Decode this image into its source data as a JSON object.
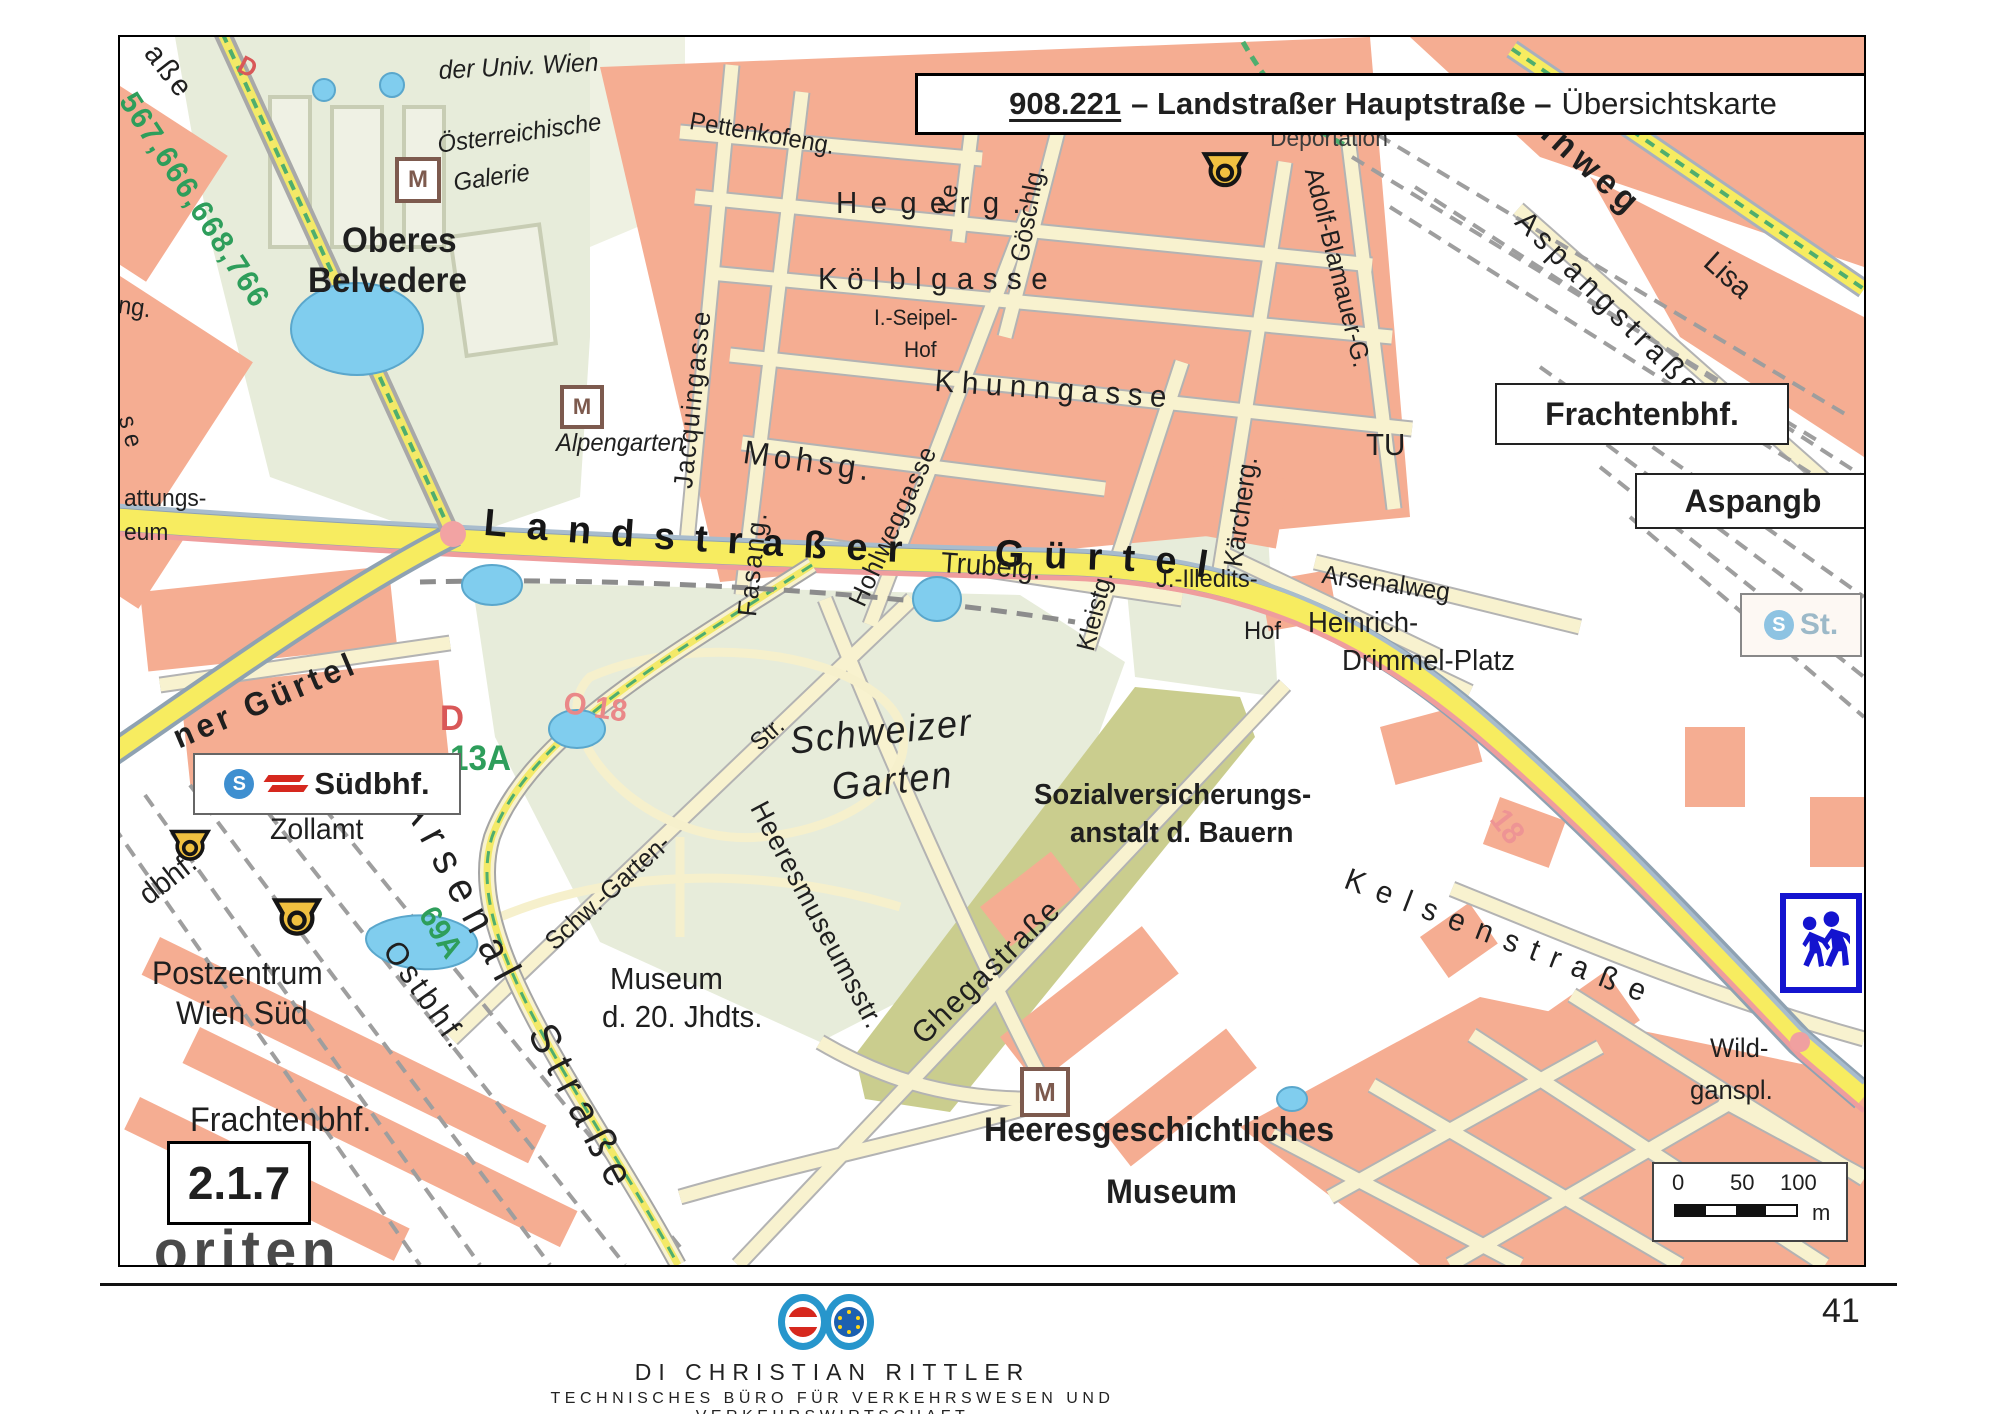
{
  "title": {
    "number": "908.221",
    "middle": "– Landstraßer Hauptstraße –",
    "suffix": "Übersichtskarte"
  },
  "map": {
    "section_label": "2.1.7",
    "guertel_label": "Landstraßer Gürtel",
    "boxes": {
      "frachtenbhf": "Frachtenbhf.",
      "aspangb": "Aspangb",
      "suedbhf": "Südbhf.",
      "st": "St."
    },
    "icons": {
      "museum_glyph": "M",
      "sbahn_glyph": "S"
    },
    "scale": {
      "t0": "0",
      "t50": "50",
      "t100": "100",
      "unit": "m"
    },
    "labels": [
      {
        "t": "aße",
        "x": 42,
        "y": 2,
        "s": 30,
        "r": 52,
        "ls": 4
      },
      {
        "t": "D",
        "x": 126,
        "y": 14,
        "s": 26,
        "r": 28,
        "c": "#d95858",
        "w": 700,
        "n": "label-tram-d-fragment"
      },
      {
        "t": "567,666,668,766",
        "x": 20,
        "y": 50,
        "s": 31,
        "r": 57,
        "c": "#2e9e5b",
        "w": 700,
        "ls": 2,
        "n": "label-bus-lines"
      },
      {
        "t": "der Univ. Wien",
        "x": 318,
        "y": 20,
        "s": 26,
        "i": 1,
        "r": -3
      },
      {
        "t": "Österreichische",
        "x": 316,
        "y": 96,
        "s": 25,
        "i": 1,
        "r": -8
      },
      {
        "t": "Galerie",
        "x": 332,
        "y": 134,
        "s": 25,
        "i": 1,
        "r": -8
      },
      {
        "t": "Oberes",
        "x": 222,
        "y": 186,
        "s": 35,
        "w": 600
      },
      {
        "t": "Belvedere",
        "x": 188,
        "y": 226,
        "s": 35,
        "w": 600
      },
      {
        "t": "Alpengarten",
        "x": 436,
        "y": 394,
        "s": 25,
        "i": 1
      },
      {
        "t": "Pettenkofeng.",
        "x": 572,
        "y": 72,
        "s": 25,
        "r": 10
      },
      {
        "t": "Ke",
        "x": 815,
        "y": 175,
        "s": 25,
        "r": -84
      },
      {
        "t": "Hegerg.",
        "x": 716,
        "y": 150,
        "s": 31,
        "ls": 14
      },
      {
        "t": "Kölblgasse",
        "x": 698,
        "y": 226,
        "s": 31,
        "ls": 10
      },
      {
        "t": "I.-Seipel-",
        "x": 754,
        "y": 270,
        "s": 22
      },
      {
        "t": "Hof",
        "x": 784,
        "y": 302,
        "s": 22,
        "n": "label-seipel-hof"
      },
      {
        "t": "Khunngasse",
        "x": 816,
        "y": 328,
        "s": 31,
        "ls": 8,
        "r": 4
      },
      {
        "t": "Mohsg.",
        "x": 626,
        "y": 398,
        "s": 33,
        "ls": 5,
        "r": 8
      },
      {
        "t": "Trubelg.",
        "x": 822,
        "y": 512,
        "s": 29,
        "r": 4
      },
      {
        "t": "Jacquingasse",
        "x": 550,
        "y": 450,
        "s": 27,
        "r": -84,
        "ls": 2
      },
      {
        "t": "Fasang.",
        "x": 614,
        "y": 578,
        "s": 27,
        "r": -84,
        "ls": 2
      },
      {
        "t": "Hohlweggasse",
        "x": 724,
        "y": 562,
        "s": 26,
        "r": -65,
        "ls": 1
      },
      {
        "t": "Göschlg.",
        "x": 886,
        "y": 222,
        "s": 26,
        "r": -80
      },
      {
        "t": "Kleistg.",
        "x": 952,
        "y": 610,
        "s": 26,
        "r": -76
      },
      {
        "t": "Kärcherg.",
        "x": 1100,
        "y": 528,
        "s": 27,
        "r": -82
      },
      {
        "t": "Adolf-Blamauer-G.",
        "x": 1206,
        "y": 128,
        "s": 26,
        "r": 76
      },
      {
        "t": "Deportation",
        "x": 1150,
        "y": 90,
        "s": 24,
        "c": "#3c3c3c"
      },
      {
        "t": "nnweg",
        "x": 1430,
        "y": 70,
        "s": 35,
        "r": 42,
        "ls": 6,
        "w": 600
      },
      {
        "t": "Lisa",
        "x": 1598,
        "y": 210,
        "s": 30,
        "r": 42
      },
      {
        "t": "Aspangstraße",
        "x": 1412,
        "y": 168,
        "s": 31,
        "r": 45,
        "ls": 6
      },
      {
        "t": "TU",
        "x": 1246,
        "y": 392,
        "s": 31
      },
      {
        "t": "Arsenalweg",
        "x": 1204,
        "y": 524,
        "s": 26,
        "r": 8
      },
      {
        "t": "J.-Illedits-",
        "x": 1036,
        "y": 530,
        "s": 25
      },
      {
        "t": "Hof",
        "x": 1124,
        "y": 582,
        "s": 25,
        "n": "label-illedits-hof"
      },
      {
        "t": "Heinrich-",
        "x": 1188,
        "y": 572,
        "s": 29
      },
      {
        "t": "Drimmel-Platz",
        "x": 1222,
        "y": 610,
        "s": 29
      },
      {
        "t": "Kelsenstraße",
        "x": 1232,
        "y": 826,
        "s": 31,
        "r": 21,
        "ls": 14
      },
      {
        "t": "18",
        "x": 1390,
        "y": 766,
        "s": 32,
        "r": 52,
        "c": "#ee9494",
        "w": 700,
        "n": "label-tram-18"
      },
      {
        "t": "Wild-",
        "x": 1590,
        "y": 998,
        "s": 27
      },
      {
        "t": "ganspl.",
        "x": 1570,
        "y": 1040,
        "s": 27
      },
      {
        "t": "Sozialversicherungs-",
        "x": 914,
        "y": 744,
        "s": 29,
        "w": 600
      },
      {
        "t": "anstalt d. Bauern",
        "x": 950,
        "y": 782,
        "s": 29,
        "w": 600
      },
      {
        "t": "Schweizer",
        "x": 668,
        "y": 686,
        "s": 38,
        "i": 1,
        "r": -6,
        "ls": 2
      },
      {
        "t": "Garten",
        "x": 710,
        "y": 732,
        "s": 38,
        "i": 1,
        "r": -6,
        "ls": 2
      },
      {
        "t": "Str.",
        "x": 626,
        "y": 700,
        "s": 25,
        "r": -42
      },
      {
        "t": "Schw.-Garten-",
        "x": 420,
        "y": 898,
        "s": 26,
        "r": -42
      },
      {
        "t": "Heeresmuseumsstr.",
        "x": 650,
        "y": 760,
        "s": 28,
        "r": 62,
        "ls": 1
      },
      {
        "t": "Ghegastraße",
        "x": 786,
        "y": 990,
        "s": 31,
        "r": -44,
        "ls": 2
      },
      {
        "t": "Museum",
        "x": 490,
        "y": 926,
        "s": 31,
        "n": "label-museum-20"
      },
      {
        "t": "d. 20. Jhdts.",
        "x": 482,
        "y": 964,
        "s": 31
      },
      {
        "t": "Heeresgeschichtliches",
        "x": 864,
        "y": 1076,
        "s": 34,
        "w": 600
      },
      {
        "t": "Museum",
        "x": 986,
        "y": 1138,
        "s": 34,
        "w": 600,
        "n": "label-heeresgesch-museum"
      },
      {
        "t": "ner Gürtel",
        "x": 48,
        "y": 686,
        "s": 33,
        "r": -23,
        "ls": 5,
        "w": 600
      },
      {
        "t": "D",
        "x": 320,
        "y": 664,
        "s": 35,
        "c": "#d95858",
        "w": 700,
        "n": "label-tram-d"
      },
      {
        "t": "O 18",
        "x": 446,
        "y": 650,
        "s": 31,
        "r": 8,
        "c": "#ea8888",
        "w": 700,
        "n": "label-tram-o-18"
      },
      {
        "t": "13A",
        "x": 330,
        "y": 704,
        "s": 35,
        "c": "#2e9e5b",
        "w": 700,
        "n": "label-bus-13a"
      },
      {
        "t": "69A",
        "x": 320,
        "y": 864,
        "s": 31,
        "r": 58,
        "c": "#2e9e5b",
        "w": 700,
        "n": "label-bus-69a"
      },
      {
        "t": "Zollamt",
        "x": 150,
        "y": 778,
        "s": 30
      },
      {
        "t": "dbhf.",
        "x": 14,
        "y": 850,
        "s": 30,
        "r": -38
      },
      {
        "t": "Postzentrum",
        "x": 32,
        "y": 920,
        "s": 32
      },
      {
        "t": "Wien Süd",
        "x": 56,
        "y": 960,
        "s": 32
      },
      {
        "t": "Ostbhf.",
        "x": 284,
        "y": 898,
        "s": 32,
        "r": 55,
        "ls": 4
      },
      {
        "t": "Frachtenbhf.",
        "x": 70,
        "y": 1066,
        "s": 34,
        "n": "label-frachtenbhf-south"
      },
      {
        "t": "Arsenal",
        "x": 312,
        "y": 750,
        "s": 42,
        "r": 62,
        "ls": 12,
        "n": "label-arsenal-strasse-1"
      },
      {
        "t": "Straße",
        "x": 438,
        "y": 980,
        "s": 42,
        "r": 62,
        "ls": 12,
        "n": "label-arsenal-strasse-2"
      },
      {
        "t": "oriten",
        "x": 34,
        "y": 1186,
        "s": 58,
        "w": 700,
        "c": "#4a4a4a",
        "ls": 6
      },
      {
        "t": "ng.",
        "x": 0,
        "y": 256,
        "s": 25,
        "r": 8
      },
      {
        "t": "s e",
        "x": 18,
        "y": 376,
        "s": 25,
        "r": 75
      },
      {
        "t": "attungs-",
        "x": 4,
        "y": 450,
        "s": 24
      },
      {
        "t": "eum",
        "x": 4,
        "y": 484,
        "s": 24
      }
    ]
  },
  "footer": {
    "name": "DI Christian Rittler",
    "subtitle": "Technisches Büro für Verkehrswesen und Verkehrswirtschaft",
    "page_number": "41"
  }
}
